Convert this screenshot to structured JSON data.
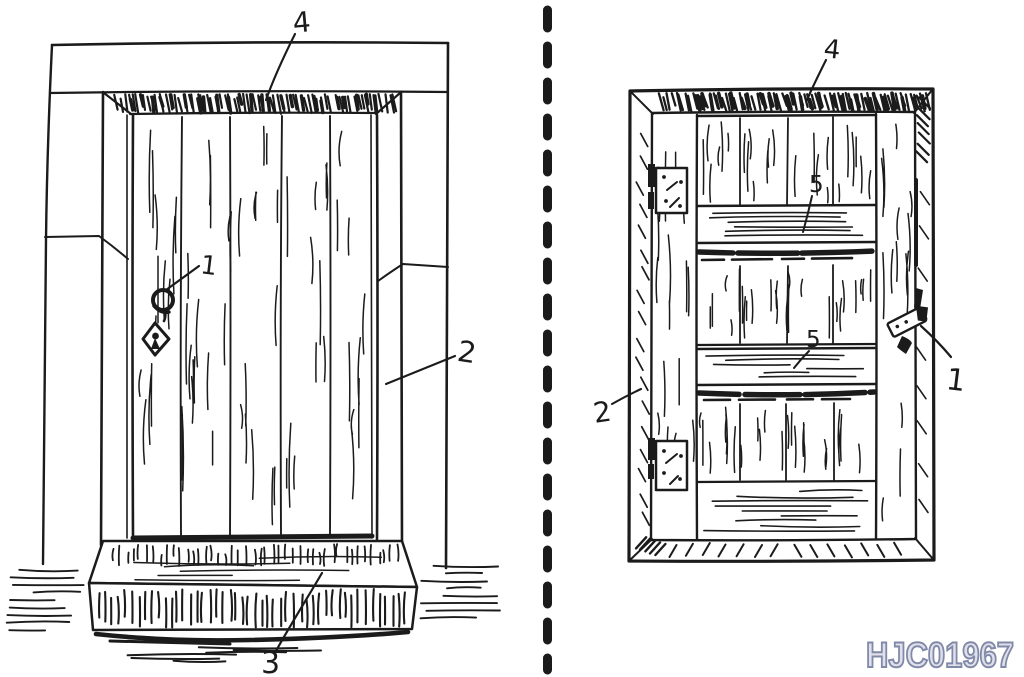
{
  "page": {
    "kind": "scanned hand-drawn illustration of two doors",
    "separator_style": "vertical dashed line"
  },
  "colors": {
    "ink": "#1b1b1b",
    "paper": "#ffffff",
    "watermark_fill": "#dfe0ea",
    "watermark_stroke": "#8189a8"
  },
  "left_figure": {
    "description": "outside view: plank door in masonry opening with step",
    "labels": {
      "handle": "1",
      "frame_jamb": "2",
      "threshold_step": "3",
      "lintel": "4"
    }
  },
  "right_figure": {
    "description": "inside view: ledged door with hinges and latch",
    "labels": {
      "latch": "1",
      "frame": "2",
      "lintel": "4",
      "upper_ledge": "5",
      "lower_ledge": "5"
    }
  },
  "watermark": {
    "text": "HJC01967"
  }
}
